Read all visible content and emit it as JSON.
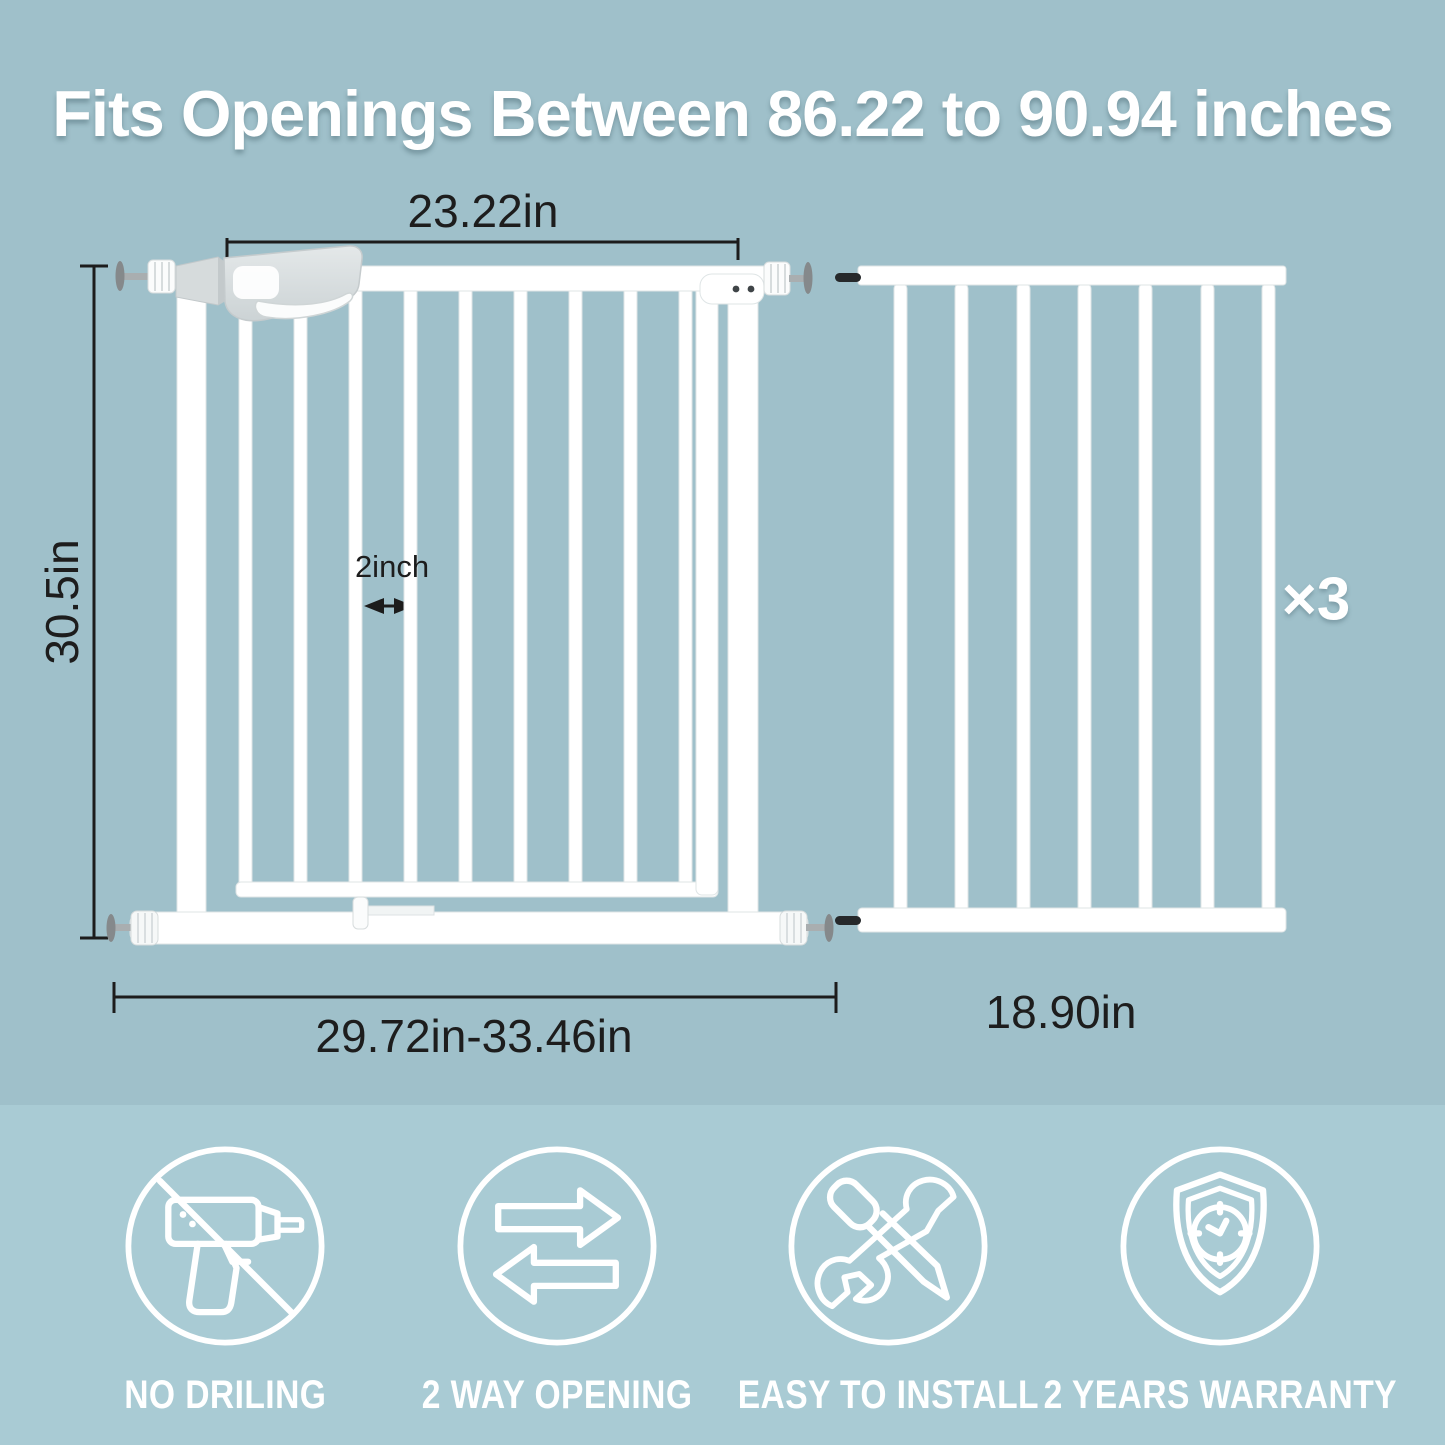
{
  "title": "Fits Openings Between 86.22 to 90.94 inches",
  "diagram": {
    "gate": {
      "door_width_label": "23.22in",
      "height_label": "30.5in",
      "bar_gap_label": "2inch",
      "width_range_label": "29.72in-33.46in"
    },
    "extension": {
      "width_label": "18.90in",
      "quantity_label": "×3"
    }
  },
  "features": [
    {
      "icon": "no-drilling-icon",
      "label": "NO DRILING"
    },
    {
      "icon": "two-way-opening-icon",
      "label": "2 WAY OPENING"
    },
    {
      "icon": "easy-install-icon",
      "label": "EASY TO INSTALL"
    },
    {
      "icon": "warranty-icon",
      "label": "2 YEARS WARRANTY"
    }
  ],
  "colors": {
    "background_top": "#9fc0ca",
    "background_bottom": "#a9cbd4",
    "gate_white": "#ffffff",
    "dimension_text": "#1d1d1d",
    "latch_gray": "#d9dedf"
  }
}
